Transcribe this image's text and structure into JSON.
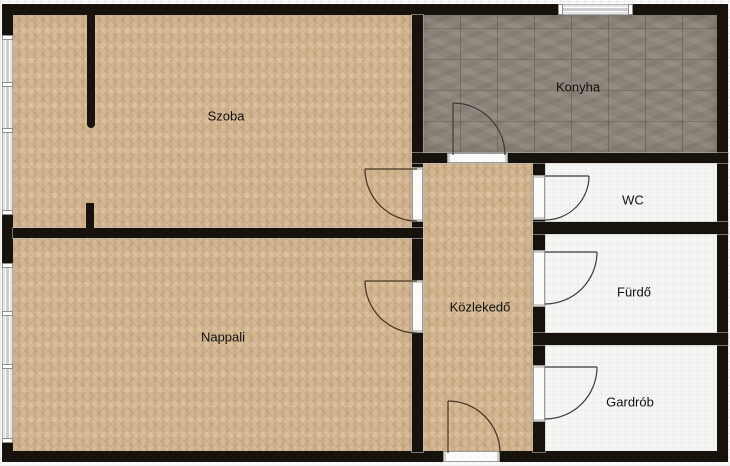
{
  "rooms": {
    "szoba": {
      "label": "Szoba"
    },
    "nappali": {
      "label": "Nappali"
    },
    "konyha": {
      "label": "Konyha"
    },
    "kozlekedo": {
      "label": "Közlekedő"
    },
    "wc": {
      "label": "WC"
    },
    "furdo": {
      "label": "Fürdő"
    },
    "gardrob": {
      "label": "Gardrób"
    }
  },
  "colors": {
    "wall": "#17120c",
    "parquet": "#d8ba93",
    "tile": "#8d8479",
    "white_floor": "#f5f5f4",
    "paper": "#fcfcfc",
    "door_arc": "#4a3a28",
    "label_text": "#111111"
  }
}
